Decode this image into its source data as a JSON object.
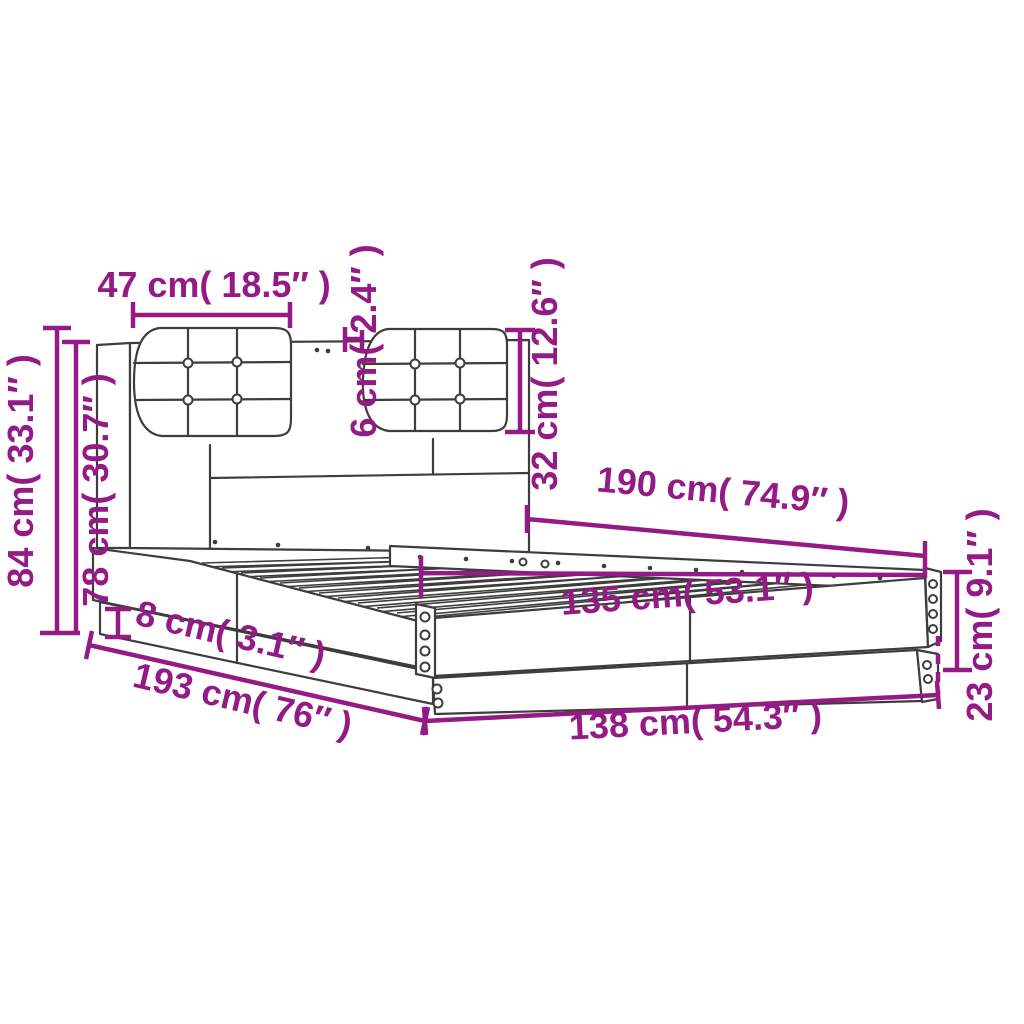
{
  "figure": {
    "type": "product-dimension-diagram",
    "subject": "bed frame with headboard and two tufted cushions",
    "background": "#ffffff"
  },
  "colors": {
    "dimension": "#941a85",
    "line_art": "#3d3d3d"
  },
  "units": {
    "primary": "cm",
    "secondary": "inches"
  },
  "dimensions": [
    {
      "id": "cushion-width",
      "label": "47 cm( 18.5″ )",
      "cm": 47,
      "inches": 18.5,
      "orientation": "horizontal"
    },
    {
      "id": "cushion-depth",
      "label": "6 cm( 2.4″ )",
      "cm": 6,
      "inches": 2.4,
      "orientation": "vertical-rotated"
    },
    {
      "id": "cushion-height",
      "label": "32 cm( 12.6″ )",
      "cm": 32,
      "inches": 12.6,
      "orientation": "vertical-rotated"
    },
    {
      "id": "total-height",
      "label": "84 cm( 33.1″ )",
      "cm": 84,
      "inches": 33.1,
      "orientation": "vertical-rotated"
    },
    {
      "id": "headboard-height",
      "label": "78 cm( 30.7″ )",
      "cm": 78,
      "inches": 30.7,
      "orientation": "vertical-rotated"
    },
    {
      "id": "inner-length",
      "label": "190 cm( 74.9″ )",
      "cm": 190,
      "inches": 74.9,
      "orientation": "diagonal"
    },
    {
      "id": "inner-width",
      "label": "135 cm( 53.1″ )",
      "cm": 135,
      "inches": 53.1,
      "orientation": "diagonal"
    },
    {
      "id": "plinth-height",
      "label": "8 cm( 3.1″ )",
      "cm": 8,
      "inches": 3.1,
      "orientation": "diagonal"
    },
    {
      "id": "total-length",
      "label": "193 cm( 76″ )",
      "cm": 193,
      "inches": 76,
      "orientation": "diagonal"
    },
    {
      "id": "total-width",
      "label": "138 cm( 54.3″ )",
      "cm": 138,
      "inches": 54.3,
      "orientation": "diagonal"
    },
    {
      "id": "frame-height",
      "label": "23 cm( 9.1″ )",
      "cm": 23,
      "inches": 9.1,
      "orientation": "vertical-rotated"
    }
  ]
}
